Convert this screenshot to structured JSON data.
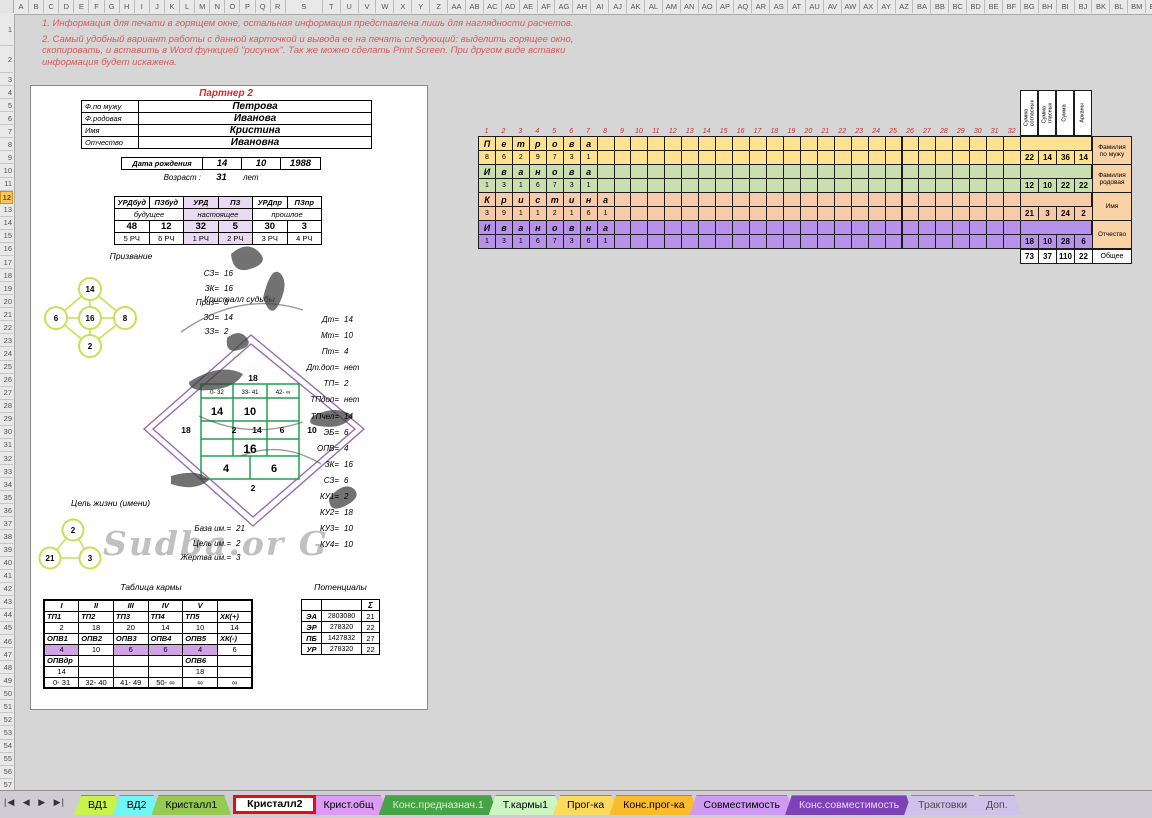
{
  "spreadsheet": {
    "column_headers": [
      "A",
      "B",
      "C",
      "D",
      "E",
      "F",
      "G",
      "H",
      "I",
      "J",
      "K",
      "L",
      "M",
      "N",
      "O",
      "P",
      "Q",
      "R",
      "S",
      "T",
      "U",
      "V",
      "W",
      "X",
      "Y",
      "Z",
      "AA",
      "AB",
      "AC",
      "AD",
      "AE",
      "AF",
      "AG",
      "AH",
      "AI",
      "AJ",
      "AK",
      "AL",
      "AM",
      "AN",
      "AO",
      "AP",
      "AQ",
      "AR",
      "AS",
      "AT",
      "AU",
      "AV",
      "AW",
      "AX",
      "AY",
      "AZ",
      "BA",
      "BB",
      "BC",
      "BD",
      "BE",
      "BF",
      "BG",
      "BH",
      "BI",
      "BJ",
      "BK",
      "BL",
      "BM",
      "BN"
    ],
    "row_count": 57,
    "active_row": 12
  },
  "instructions": {
    "line1": "1. Информация для печати в горящем окне, остальная информация представлена лишь для наглядности расчетов.",
    "line2": "2. Самый удобный вариант работы с данной карточкой и вывода ее на печать следующий: выделить горящее окно, скопировать, и вставить в Word функцией \"рисунок\". Так же можно сделать Print Screen. При другом виде вставки информация будет искажена."
  },
  "card": {
    "title": "Партнер 2",
    "person": {
      "rows": [
        {
          "label": "Ф.по мужу",
          "value": "Петрова"
        },
        {
          "label": "Ф.родовая",
          "value": "Иванова"
        },
        {
          "label": "Имя",
          "value": "Кристина"
        },
        {
          "label": "Отчество",
          "value": "Ивановна"
        }
      ],
      "birth_label": "Дата рождения",
      "birth": [
        "14",
        "10",
        "1988"
      ],
      "age_label": "Возраст :",
      "age": "31",
      "age_units": "лет"
    },
    "urd": {
      "headers": [
        "УРДбуд",
        "ПЗбуд",
        "УРД",
        "ПЗ",
        "УРДпр",
        "ПЗпр"
      ],
      "groups": [
        "будущее",
        "настоящее",
        "прошлое"
      ],
      "values": [
        "48",
        "12",
        "32",
        "5",
        "30",
        "3"
      ],
      "rch": [
        "5 РЧ",
        "6 РЧ",
        "1 РЧ",
        "2 РЧ",
        "3 РЧ",
        "4 РЧ"
      ],
      "accent": "#ead9f2"
    },
    "prizvanie": {
      "title": "Призвание",
      "circles": {
        "top": "14",
        "left": "6",
        "center": "16",
        "right": "8",
        "bottom": "2"
      },
      "values": [
        {
          "label": "СЗ=",
          "value": "16"
        },
        {
          "label": "ЗК=",
          "value": "16"
        },
        {
          "label": "Приз=",
          "value": "8"
        },
        {
          "label": "ЗО=",
          "value": "14"
        },
        {
          "label": "ЗЗ=",
          "value": "2"
        }
      ]
    },
    "crystal": {
      "title": "Кристалл судьбы",
      "top_number": "18",
      "ranges": [
        "0- 32",
        "33- 41",
        "42- ∞"
      ],
      "row2": [
        "14",
        "10"
      ],
      "mid": [
        "18",
        "2",
        "14",
        "6",
        "10"
      ],
      "center": "16",
      "bottom_cells": [
        "4",
        "6"
      ],
      "bottom_number": "2",
      "watermark": "Sudba.or G",
      "diamond_color": "#9a6ab0",
      "grid_color": "#1fa052"
    },
    "crystal_values": [
      {
        "label": "Дт=",
        "value": "14"
      },
      {
        "label": "Мт=",
        "value": "10"
      },
      {
        "label": "Пт=",
        "value": "4"
      },
      {
        "label": "Дт.доп=",
        "value": "нет"
      },
      {
        "label": "ТП=",
        "value": "2"
      },
      {
        "label": "ТПдоп=",
        "value": "нет"
      },
      {
        "label": "ТПчел=",
        "value": "14"
      },
      {
        "label": "ЭБ=",
        "value": "6"
      },
      {
        "label": "ОПВ=",
        "value": "4"
      },
      {
        "label": "ЗК=",
        "value": "16"
      },
      {
        "label": "СЗ=",
        "value": "6"
      },
      {
        "label": "КУ1=",
        "value": "2"
      },
      {
        "label": "КУ2=",
        "value": "18"
      },
      {
        "label": "КУ3=",
        "value": "10"
      },
      {
        "label": "КУ4=",
        "value": "10"
      }
    ],
    "goal": {
      "title": "Цель жизни (имени)",
      "circles": {
        "top": "2",
        "left": "21",
        "right": "3"
      },
      "values": [
        {
          "label": "База им.=",
          "value": "21"
        },
        {
          "label": "Цель им.=",
          "value": "2"
        },
        {
          "label": "Жертва им.=",
          "value": "3"
        }
      ]
    },
    "karma": {
      "title": "Таблица кармы",
      "rows": [
        {
          "style": "rom",
          "cells": [
            "I",
            "II",
            "III",
            "IV",
            "V",
            ""
          ]
        },
        {
          "style": "hd",
          "cells": [
            "ТП1",
            "ТП2",
            "ТП3",
            "ТП4",
            "ТП5",
            "ХК(+)"
          ]
        },
        {
          "style": "val",
          "cells": [
            "2",
            "18",
            "20",
            "14",
            "10",
            "14"
          ]
        },
        {
          "style": "hd",
          "cells": [
            "ОПВ1",
            "ОПВ2",
            "ОПВ3",
            "ОПВ4",
            "ОПВ5",
            "ХК(-)"
          ]
        },
        {
          "style": "val",
          "cells": [
            "4",
            "10",
            "6",
            "6",
            "4",
            "6"
          ],
          "highlight": [
            0,
            2,
            3,
            4
          ]
        },
        {
          "style": "hd",
          "cells": [
            "ОПВдр",
            "",
            "",
            "",
            "ОПВ6",
            ""
          ]
        },
        {
          "style": "val",
          "cells": [
            "14",
            "",
            "",
            "",
            "18",
            ""
          ]
        },
        {
          "style": "val",
          "cells": [
            "0- 31",
            "32- 40",
            "41- 49",
            "50- ∞",
            "∞",
            "∞"
          ]
        }
      ],
      "highlight_color": "#d1a3e2"
    },
    "potentials": {
      "title": "Потенциалы",
      "sum_symbol": "Σ",
      "rows": [
        {
          "label": "ЭА",
          "value": "2803080",
          "sum": "21"
        },
        {
          "label": "ЭР",
          "value": "278320",
          "sum": "22"
        },
        {
          "label": "ПБ",
          "value": "1427832",
          "sum": "27"
        },
        {
          "label": "УР",
          "value": "278320",
          "sum": "22"
        }
      ]
    }
  },
  "letter_grid": {
    "column_numbers": [
      "1",
      "2",
      "3",
      "4",
      "5",
      "6",
      "7",
      "8",
      "9",
      "10",
      "11",
      "12",
      "13",
      "14",
      "15",
      "16",
      "17",
      "18",
      "19",
      "20",
      "21",
      "22",
      "23",
      "24",
      "25",
      "26",
      "27",
      "28",
      "29",
      "30",
      "31",
      "32"
    ],
    "sum_headers": [
      "Сумма\nсогласных",
      "Сумма\nгласных",
      "Сумма",
      "Арканы"
    ],
    "bands": [
      {
        "name": "Фамилия\nпо мужу",
        "color": "#ffe28f",
        "letters": [
          "П",
          "е",
          "т",
          "р",
          "о",
          "в",
          "а"
        ],
        "numbers": [
          "8",
          "6",
          "2",
          "9",
          "7",
          "3",
          "1"
        ],
        "sums": [
          "22",
          "14",
          "36",
          "14"
        ]
      },
      {
        "name": "Фамилия\nродовая",
        "color": "#cadfb0",
        "letters": [
          "И",
          "в",
          "а",
          "н",
          "о",
          "в",
          "а"
        ],
        "numbers": [
          "1",
          "3",
          "1",
          "6",
          "7",
          "3",
          "1"
        ],
        "sums": [
          "12",
          "10",
          "22",
          "22"
        ]
      },
      {
        "name": "Имя",
        "color": "#f7cbaa",
        "letters": [
          "К",
          "р",
          "и",
          "с",
          "т",
          "и",
          "н",
          "а"
        ],
        "numbers": [
          "3",
          "9",
          "1",
          "1",
          "2",
          "1",
          "6",
          "1"
        ],
        "sums": [
          "21",
          "3",
          "24",
          "2"
        ]
      },
      {
        "name": "Отчество",
        "color": "#b892ea",
        "letters": [
          "И",
          "в",
          "а",
          "н",
          "о",
          "в",
          "н",
          "а"
        ],
        "numbers": [
          "1",
          "3",
          "1",
          "6",
          "7",
          "3",
          "6",
          "1"
        ],
        "sums": [
          "18",
          "10",
          "28",
          "6"
        ]
      }
    ],
    "label_color": "#f9d2a6",
    "total_label": "Общее",
    "totals": [
      "73",
      "37",
      "110",
      "22"
    ]
  },
  "tabs": {
    "nav": {
      "first": "|◀",
      "prev": "◀",
      "next": "▶",
      "last": "▶|"
    },
    "active_border": "#e01010",
    "items": [
      {
        "label": "ВД1",
        "bg": "#c9f24d",
        "fg": "#000000",
        "active": false
      },
      {
        "label": "ВД2",
        "bg": "#6ff7f7",
        "fg": "#000000",
        "active": false
      },
      {
        "label": "Кристалл1",
        "bg": "#97ca52",
        "fg": "#000000",
        "active": false
      },
      {
        "label": "Кристалл2",
        "bg": "#ffffff",
        "fg": "#000000",
        "active": true
      },
      {
        "label": "Крист.общ",
        "bg": "#dc9cf5",
        "fg": "#000000",
        "active": false
      },
      {
        "label": "Конс.предназнач.1",
        "bg": "#46a446",
        "fg": "#d9f2cf",
        "active": false
      },
      {
        "label": "Т.кармы1",
        "bg": "#ccf5c2",
        "fg": "#000000",
        "active": false
      },
      {
        "label": "Прог-ка",
        "bg": "#fbda5e",
        "fg": "#000000",
        "active": false
      },
      {
        "label": "Конс.прог-ка",
        "bg": "#fbbc2c",
        "fg": "#000000",
        "active": false
      },
      {
        "label": "Совместимость",
        "bg": "#cf9af2",
        "fg": "#000000",
        "active": false
      },
      {
        "label": "Конс.совместимость",
        "bg": "#7d42b8",
        "fg": "#e6d8f5",
        "active": false
      },
      {
        "label": "Трактовки",
        "bg": "#cfc2ea",
        "fg": "#4a4a4a",
        "active": false
      },
      {
        "label": "Доп.",
        "bg": "#cfc2ea",
        "fg": "#4a4a4a",
        "active": false
      }
    ]
  }
}
